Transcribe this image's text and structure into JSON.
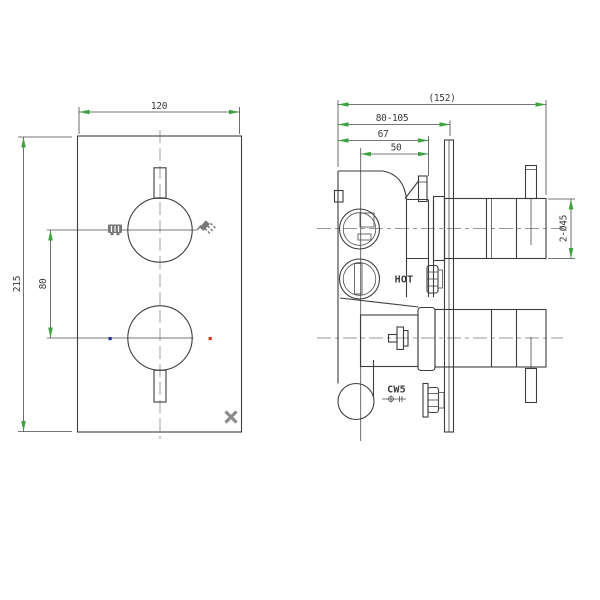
{
  "front_view": {
    "width": "120",
    "height": "215",
    "handle_spacing": "80"
  },
  "side_view": {
    "overall_depth": "(152)",
    "mounting_depth_range": "80-105",
    "body_depth": "67",
    "cartridge_depth": "50",
    "hot_inlet": "HOT",
    "outlet_port": "CW5",
    "handle_diameter": "2-Ø45"
  },
  "colors": {
    "line": "#3d3d3d",
    "dimension_arrow": "#3da33d",
    "hot_indicator": "#e03022",
    "cold_indicator": "#1f3099",
    "logo": "#8c8c8c"
  }
}
